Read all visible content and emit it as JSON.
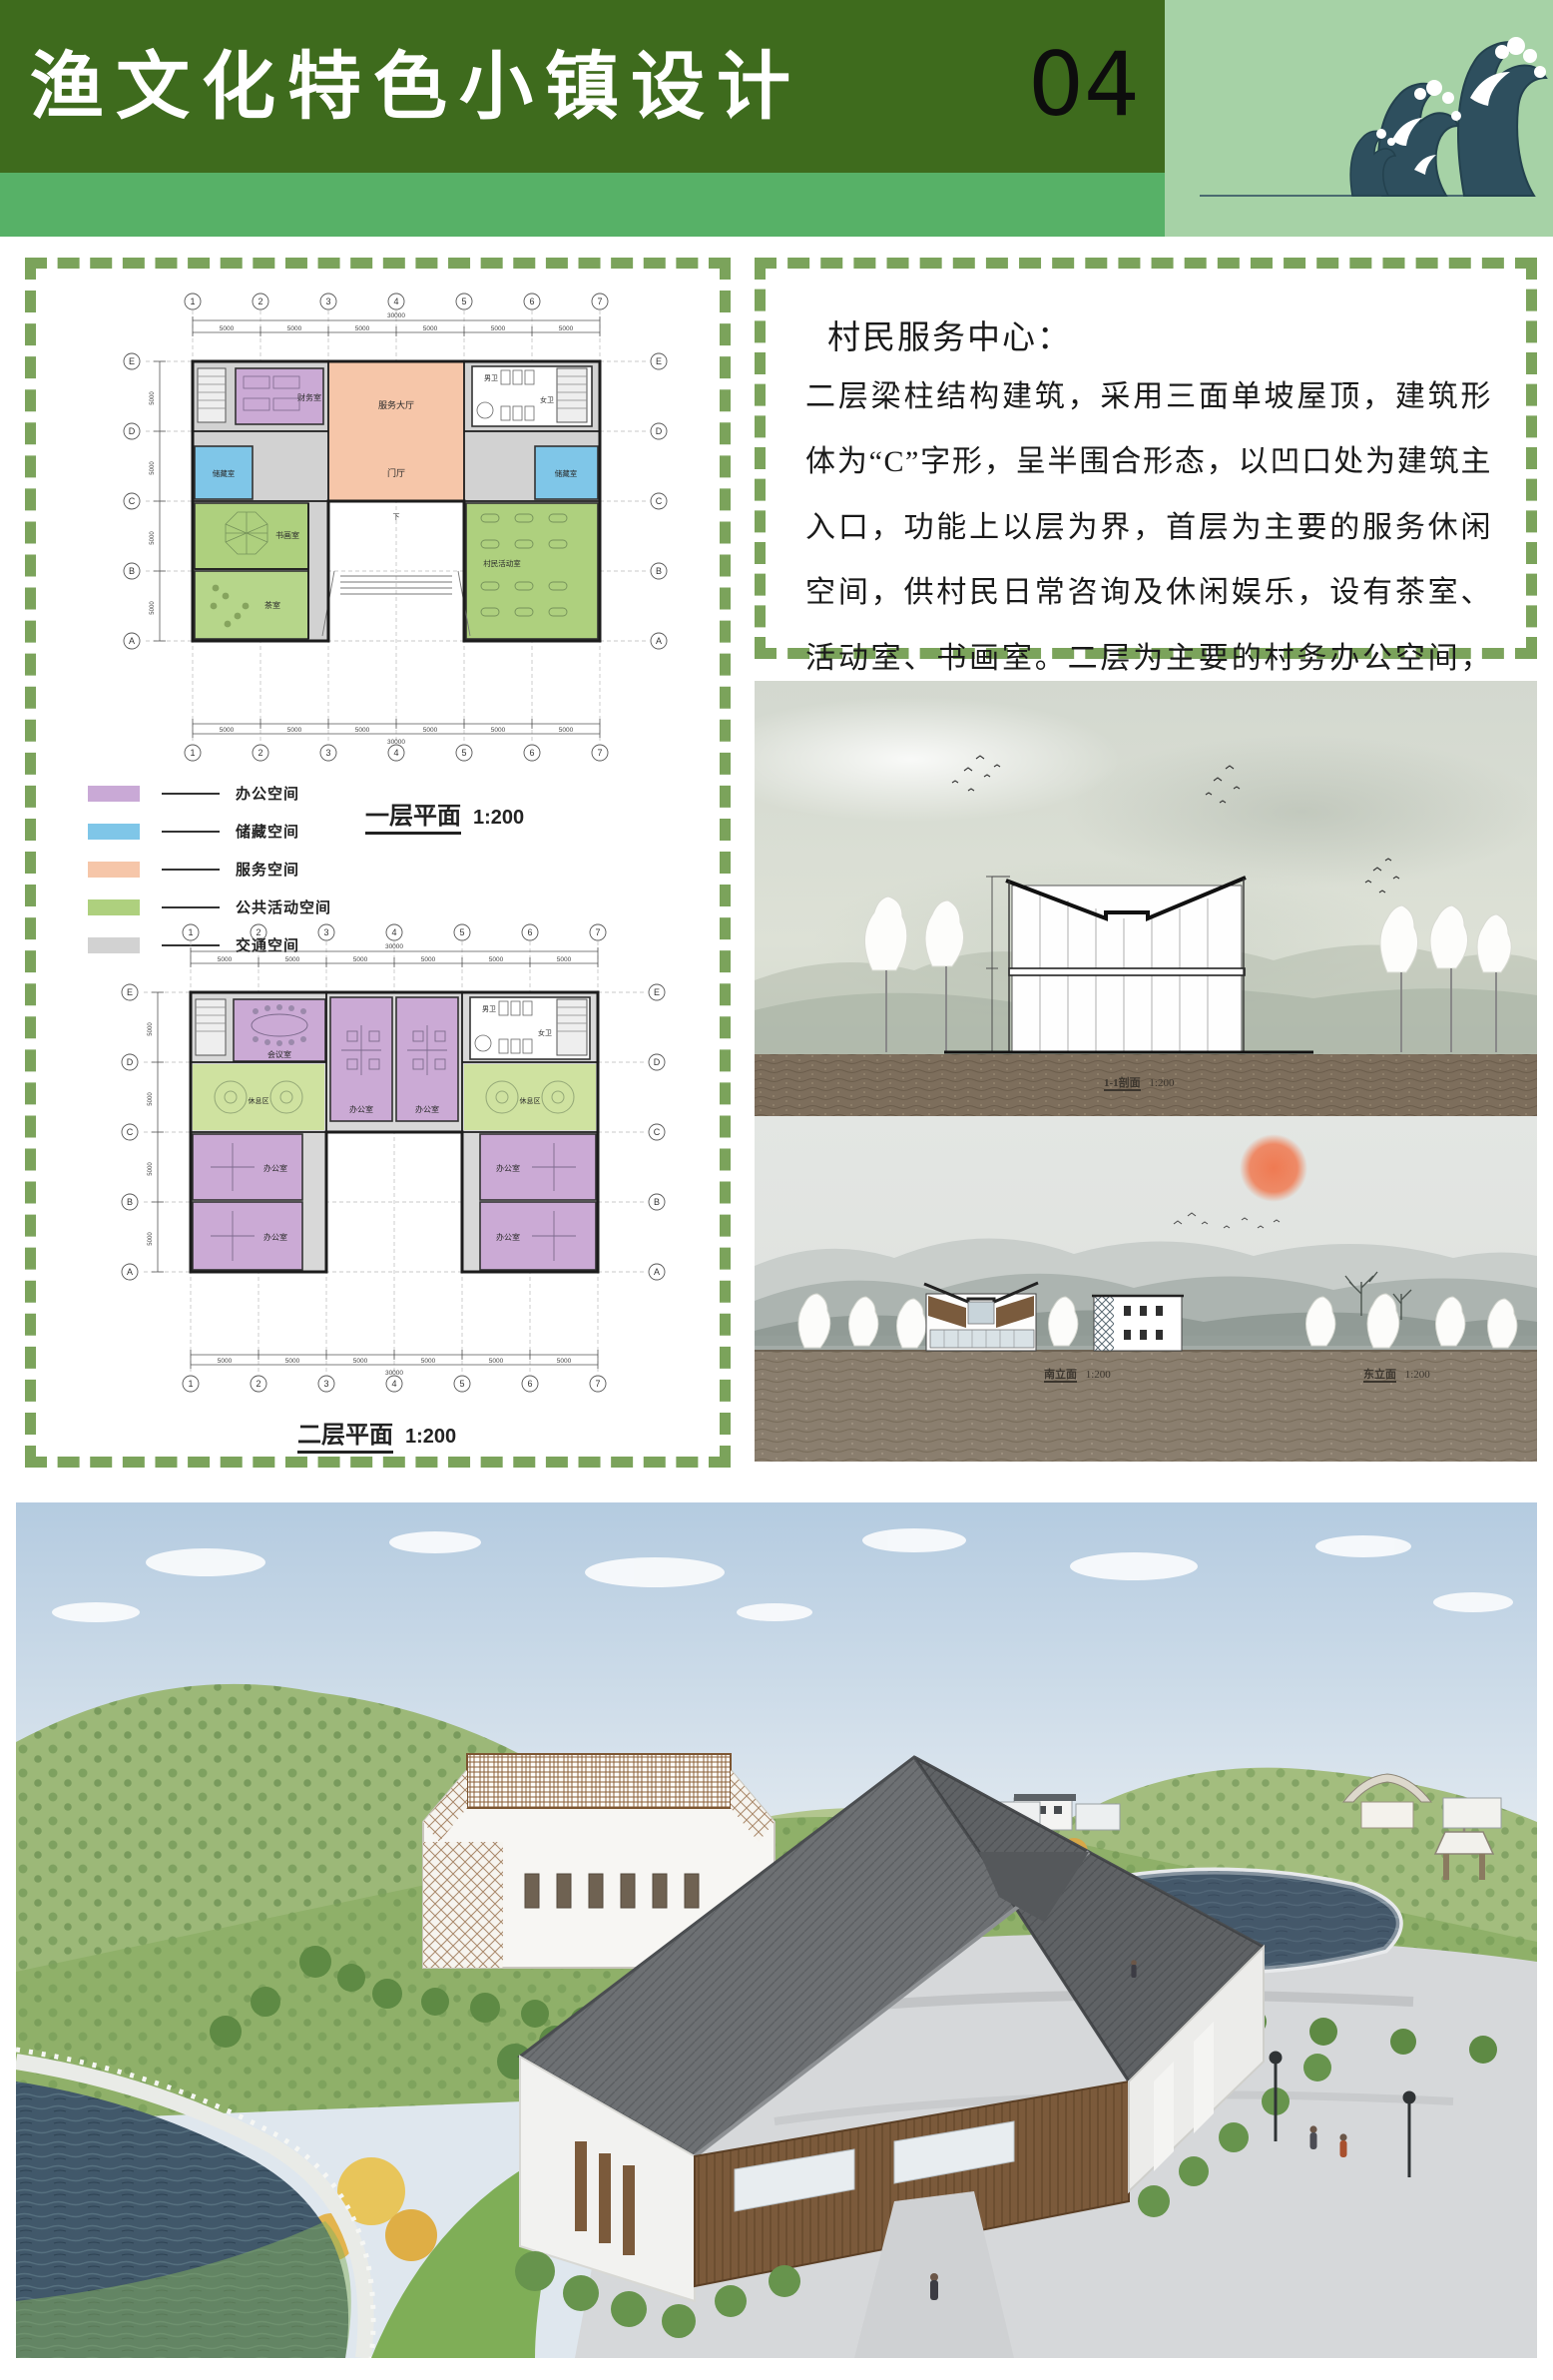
{
  "header": {
    "title": "渔文化特色小镇设计",
    "page_number": "04"
  },
  "left_panel": {
    "plan1": {
      "caption": "一层平面",
      "scale": "1:200",
      "rooms": {
        "finance": "财务室",
        "service_hall": "服务大厅",
        "foyer": "门厅",
        "storage_left": "储藏室",
        "storage_right": "储藏室",
        "calligraphy": "书画室",
        "tea": "茶室",
        "activity": "村民活动室",
        "male_wc": "男卫",
        "female_wc": "女卫",
        "down": "下"
      }
    },
    "legend": {
      "items": [
        {
          "label": "办公空间",
          "color": "#c9a9d6"
        },
        {
          "label": "储藏空间",
          "color": "#7fc6e8"
        },
        {
          "label": "服务空间",
          "color": "#f6c6a9"
        },
        {
          "label": "公共活动空间",
          "color": "#aed07e"
        },
        {
          "label": "交通空间",
          "color": "#d2d2d2"
        }
      ]
    },
    "plan2": {
      "caption": "二层平面",
      "scale": "1:200",
      "rooms": {
        "meeting": "会议室",
        "office": "办公室",
        "rest": "休息区",
        "male_wc": "男卫",
        "female_wc": "女卫"
      }
    },
    "grid": {
      "cols": [
        "1",
        "2",
        "3",
        "4",
        "5",
        "6",
        "7"
      ],
      "rows": [
        "E",
        "D",
        "C",
        "B",
        "A"
      ],
      "bay": "5000",
      "bays6": [
        "5000",
        "5000",
        "5000",
        "5000",
        "5000",
        "5000"
      ],
      "bays4": [
        "5000",
        "5000",
        "5000",
        "5000"
      ],
      "total_width": "30000",
      "total_height": "20000"
    }
  },
  "text_panel": {
    "heading": "村民服务中心：",
    "body": "二层梁柱结构建筑，采用三面单坡屋顶，建筑形体为“C”字形，呈半围合形态，以凹口处为建筑主入口，功能上以层为界，首层为主要的服务休闲空间，供村民日常咨询及休闲娱乐，设有茶室、活动室、书画室。二层为主要的村务办公空间，且设有办公休息空间"
  },
  "renderings": {
    "section": {
      "caption": "1-1剖面",
      "scale": "1:200"
    },
    "elevation": {
      "south_caption": "南立面",
      "south_scale": "1:200",
      "east_caption": "东立面",
      "east_scale": "1:200"
    }
  },
  "colors": {
    "header_green": "#3e6b1d",
    "strip_green": "#57b167",
    "wave_panel_green": "#a6d2a6",
    "dash_green": "#7ba35b",
    "wave_teal": "#2e4f5e"
  }
}
